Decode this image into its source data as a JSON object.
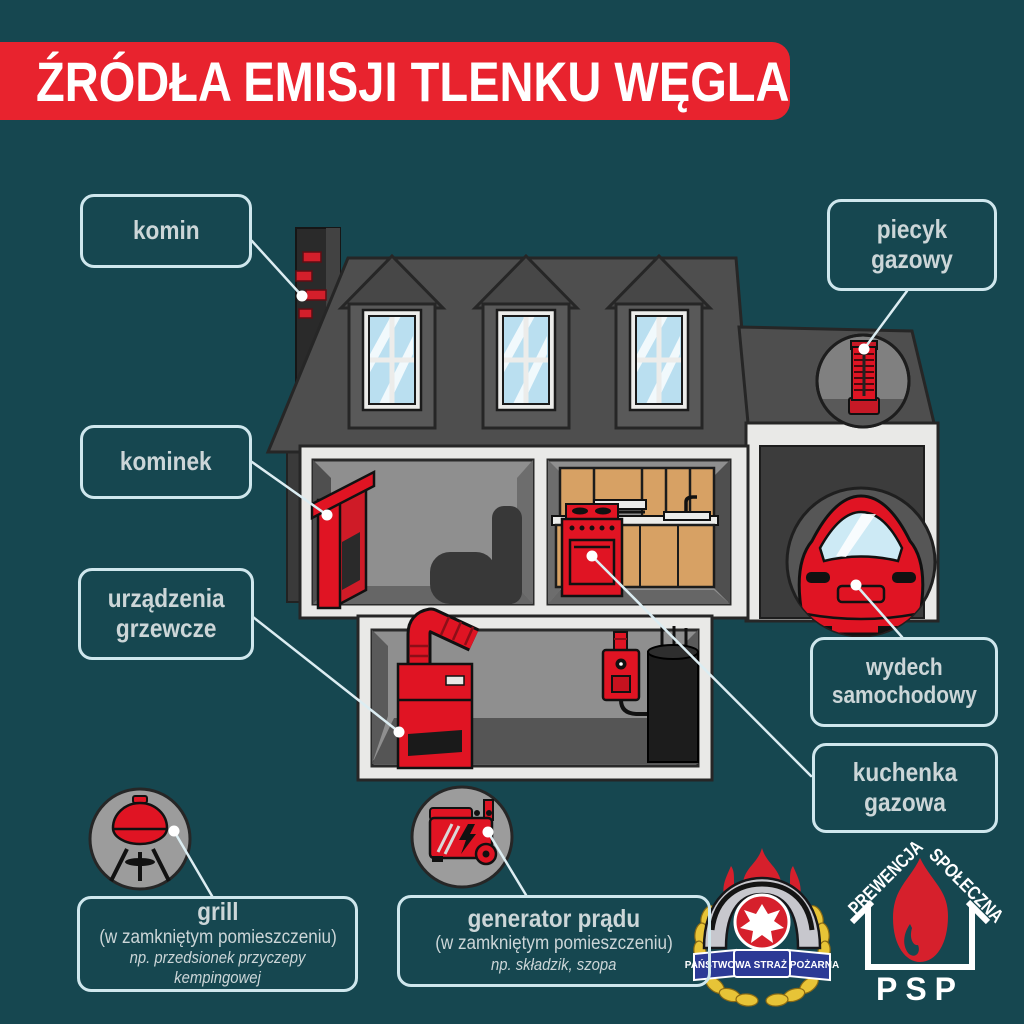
{
  "title": "ŹRÓDŁA EMISJI TLENKU WĘGLA",
  "colors": {
    "background": "#164750",
    "banner_red": "#e8232e",
    "item_red": "#e01423",
    "label_border": "#cfe7ed",
    "label_text": "#ccd6d8",
    "leader_line": "#dcedf2"
  },
  "callouts": {
    "komin": "komin",
    "kominek": "kominek",
    "urzadzenia_grzewcze": "urządzenia\ngrzewcze",
    "piecyk_gazowy": "piecyk\ngazowy",
    "wydech_samochodowy": "wydech\nsamochodowy",
    "kuchenka_gazowa": "kuchenka\ngazowa"
  },
  "info_boxes": {
    "grill": {
      "title": "grill",
      "subtitle": "(w zamkniętym pomieszczeniu)",
      "example": "np. przedsionek przyczepy kempingowej"
    },
    "generator": {
      "title": "generator prądu",
      "subtitle": "(w zamkniętym pomieszczeniu)",
      "example": "np. składzik, szopa"
    }
  },
  "logos": {
    "straz": {
      "ribbon": "PAŃSTWOWA STRAŻ POŻARNA"
    },
    "prewencja": {
      "word_left": "PREWENCJA",
      "word_right": "SPOŁECZNA",
      "abbr": "PSP"
    }
  }
}
